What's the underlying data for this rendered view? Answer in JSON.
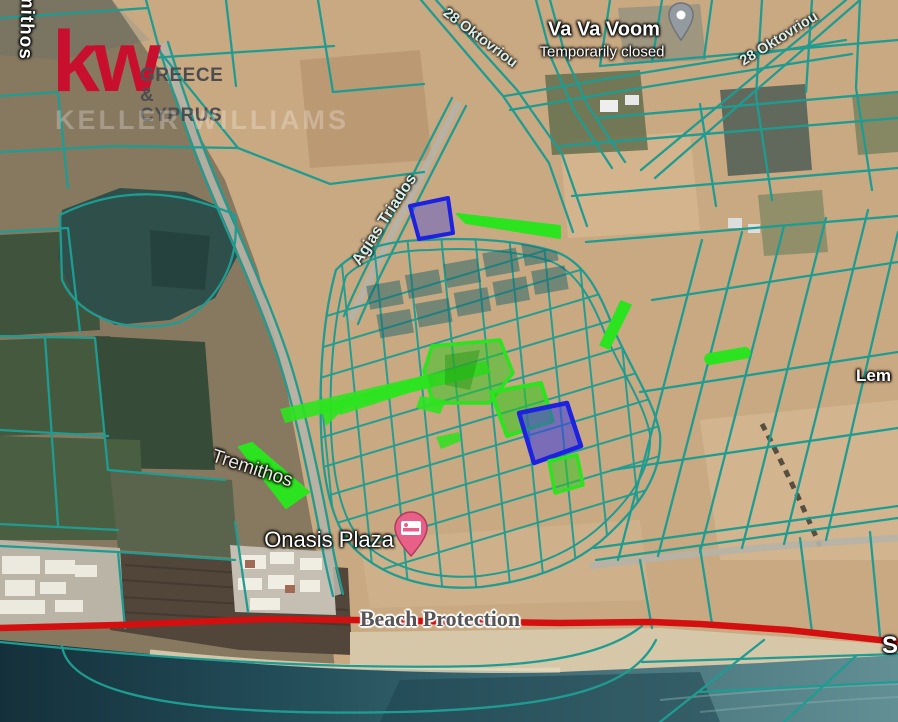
{
  "app": {
    "type": "satellite-map-with-cadastral-overlay"
  },
  "labels": {
    "logo": {
      "kw": "kw",
      "region1": "GREECE &",
      "region2": "CYPRUS",
      "watermark": "KELLER WILLIAMS"
    },
    "streets": {
      "oktovriou_west": "28 Oktovriou",
      "oktovriou_east": "28 Oktovriou",
      "agias_triados": "Agias Triados",
      "tremithos": "Tremithos",
      "tremithos_partial": "mithos",
      "lemesou_partial": "Lem",
      "coast_partial": "S"
    },
    "poi": {
      "vavavoom": {
        "name": "Va Va Voom",
        "status": "Temporarily closed"
      },
      "onasis": {
        "name": "Onasis Plaza"
      }
    },
    "overlays": {
      "beach_protection": "Beach Protection"
    }
  },
  "icons": {
    "hotel_pin": "hotel-bed-pin",
    "generic_pin": "gray-poi-pin"
  },
  "colors": {
    "parcel_line_teal": "#1f9c91",
    "highlight_green": "#2ce31f",
    "highlight_blue": "#1c22df",
    "beach_protection_red": "#d40f0f",
    "kw_red": "#c8102e",
    "hotel_pin_pink": "#e85f88",
    "poi_pin_gray": "#939aa0",
    "sea_dark": "#14303b",
    "land_tan": "#c9a982"
  }
}
